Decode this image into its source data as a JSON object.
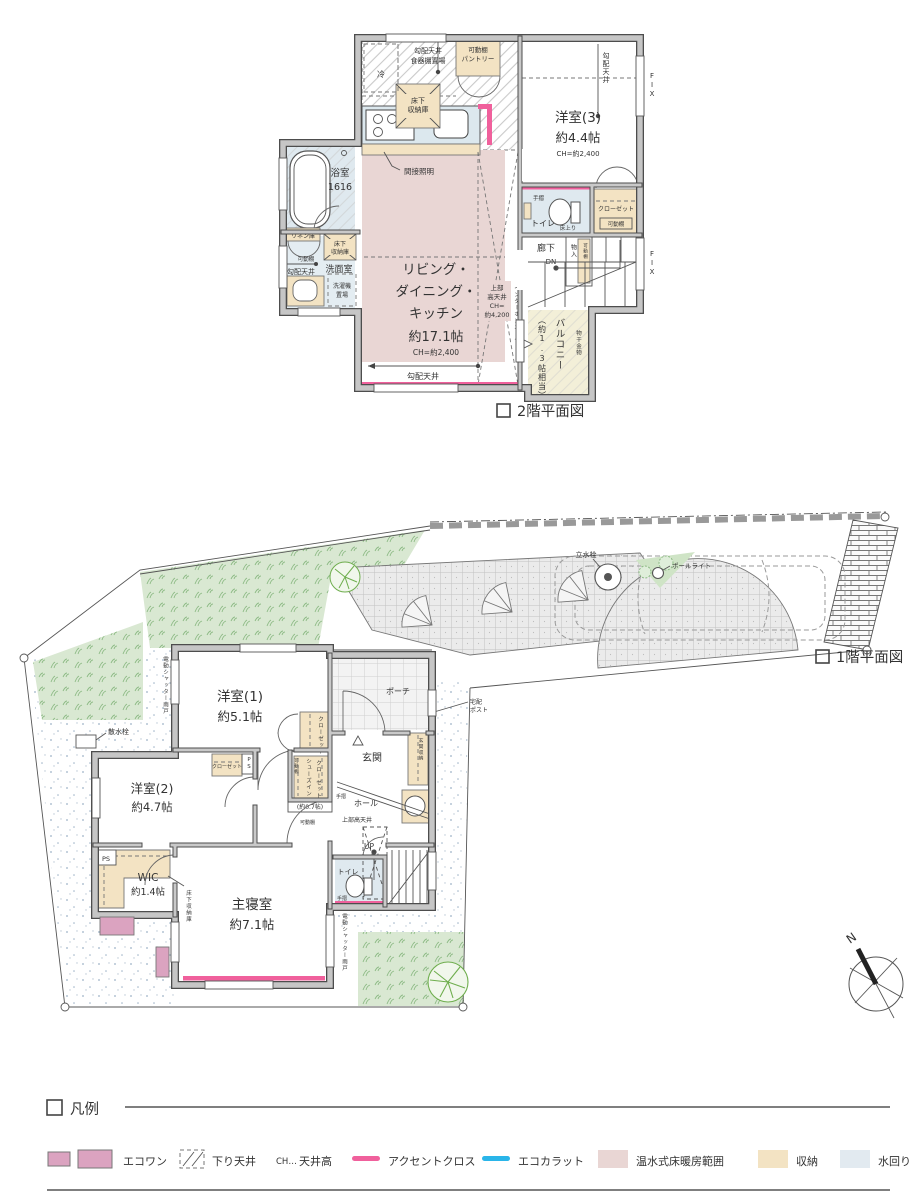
{
  "colors": {
    "wall": "#c6c6c6",
    "wall_edge": "#4d4d4d",
    "floor_heating": "#e9d6d4",
    "storage": "#f3e3c3",
    "water_area": "#dfe9ef",
    "balcony": "#f3efd8",
    "accent_cross": "#f0609c",
    "ecocarat": "#2ab5e9",
    "ecoone": "#dba3c0",
    "lawn": "#d9e8d2",
    "tree": "#6fae4e"
  },
  "floor2": {
    "title": "2階平面図",
    "labels": {
      "fridge": "冷",
      "slope_top": "勾配天井",
      "dish_shelf": "食器棚置場",
      "pantry_shelf": "可動棚",
      "pantry": "パントリー",
      "fsk1": "床下",
      "fsk2": "収納庫",
      "indirect": "間接照明",
      "ldk1": "リビング・",
      "ldk2": "ダイニング・",
      "ldk3": "キッチン",
      "ldk4": "約17.1帖",
      "ldk_ch": "CH=約2,400",
      "hc1": "上部",
      "hc2": "高天井",
      "hc3": "CH=",
      "hc4": "約4,200",
      "intercom": "インターホンニッチ",
      "slope_bottom": "勾配天井",
      "y3name": "洋室(3)",
      "y3size": "約4.4帖",
      "y3ch": "CH=約2,400",
      "y3slope": "勾配天井",
      "fix1": "FIX",
      "fix2": "FIX",
      "bath": "浴室",
      "bath_size": "1616",
      "linen": "リネン庫",
      "wash_shelf": "可動棚",
      "wash_slope": "勾配天井",
      "washroom": "洗面室",
      "laundry1": "洗濯機",
      "laundry2": "置場",
      "fsw1": "床下",
      "fsw2": "収納庫",
      "toilet": "トイレ",
      "toilet_rail": "手摺",
      "toilet_step": "床上り",
      "closet": "クローゼット",
      "closet_shelf": "可動棚",
      "hall": "廊下",
      "dn": "DN",
      "mono": "物入",
      "mono_shelf": "可動棚",
      "bal_size": "（約1.3帖相当）",
      "balcony": "バルコニー",
      "drying": "物干金物"
    }
  },
  "floor1": {
    "title": "1階平面図",
    "labels": {
      "tap": "立水栓",
      "pole": "ポールライト",
      "sansui": "散水栓",
      "shutter1": "電動シャッター雨戸",
      "shutter2": "電動シャッター雨戸",
      "y1name": "洋室(1)",
      "y1size": "約5.1帖",
      "y1closet": "クローゼット",
      "y2name": "洋室(2)",
      "y2size": "約4.7帖",
      "y2closet": "クローゼット",
      "y2ps": "PS",
      "wicps": "PS",
      "wic": "WIC",
      "wic_size": "約1.4帖",
      "fs": "床下収納庫",
      "master": "主寝室",
      "master_size": "約7.1帖",
      "sic1": "シューズイン",
      "sic2": "クローゼット",
      "sic_size": "(約0.7帖)",
      "sic_shelf1": "可動棚",
      "sic_shelf2": "可動棚",
      "porch": "ポーチ",
      "genkan": "玄関",
      "g_storage": "玄関収納",
      "post1": "宅配",
      "post2": "ポスト",
      "hall": "ホール",
      "hall_rail": "手摺",
      "uhc": "上部高天井",
      "up": "UP",
      "toilet": "トイレ",
      "toilet_rail": "手摺",
      "north": "N"
    }
  },
  "legend": {
    "title": "凡例",
    "ecoone": "エコワン",
    "lowered_ceiling": "下り天井",
    "ch_mark": "CH…",
    "ceiling_height": "天井高",
    "accent_cross": "アクセントクロス",
    "ecocarat": "エコカラット",
    "floor_heating": "温水式床暖房範囲",
    "storage": "収納",
    "water_area": "水回り"
  }
}
